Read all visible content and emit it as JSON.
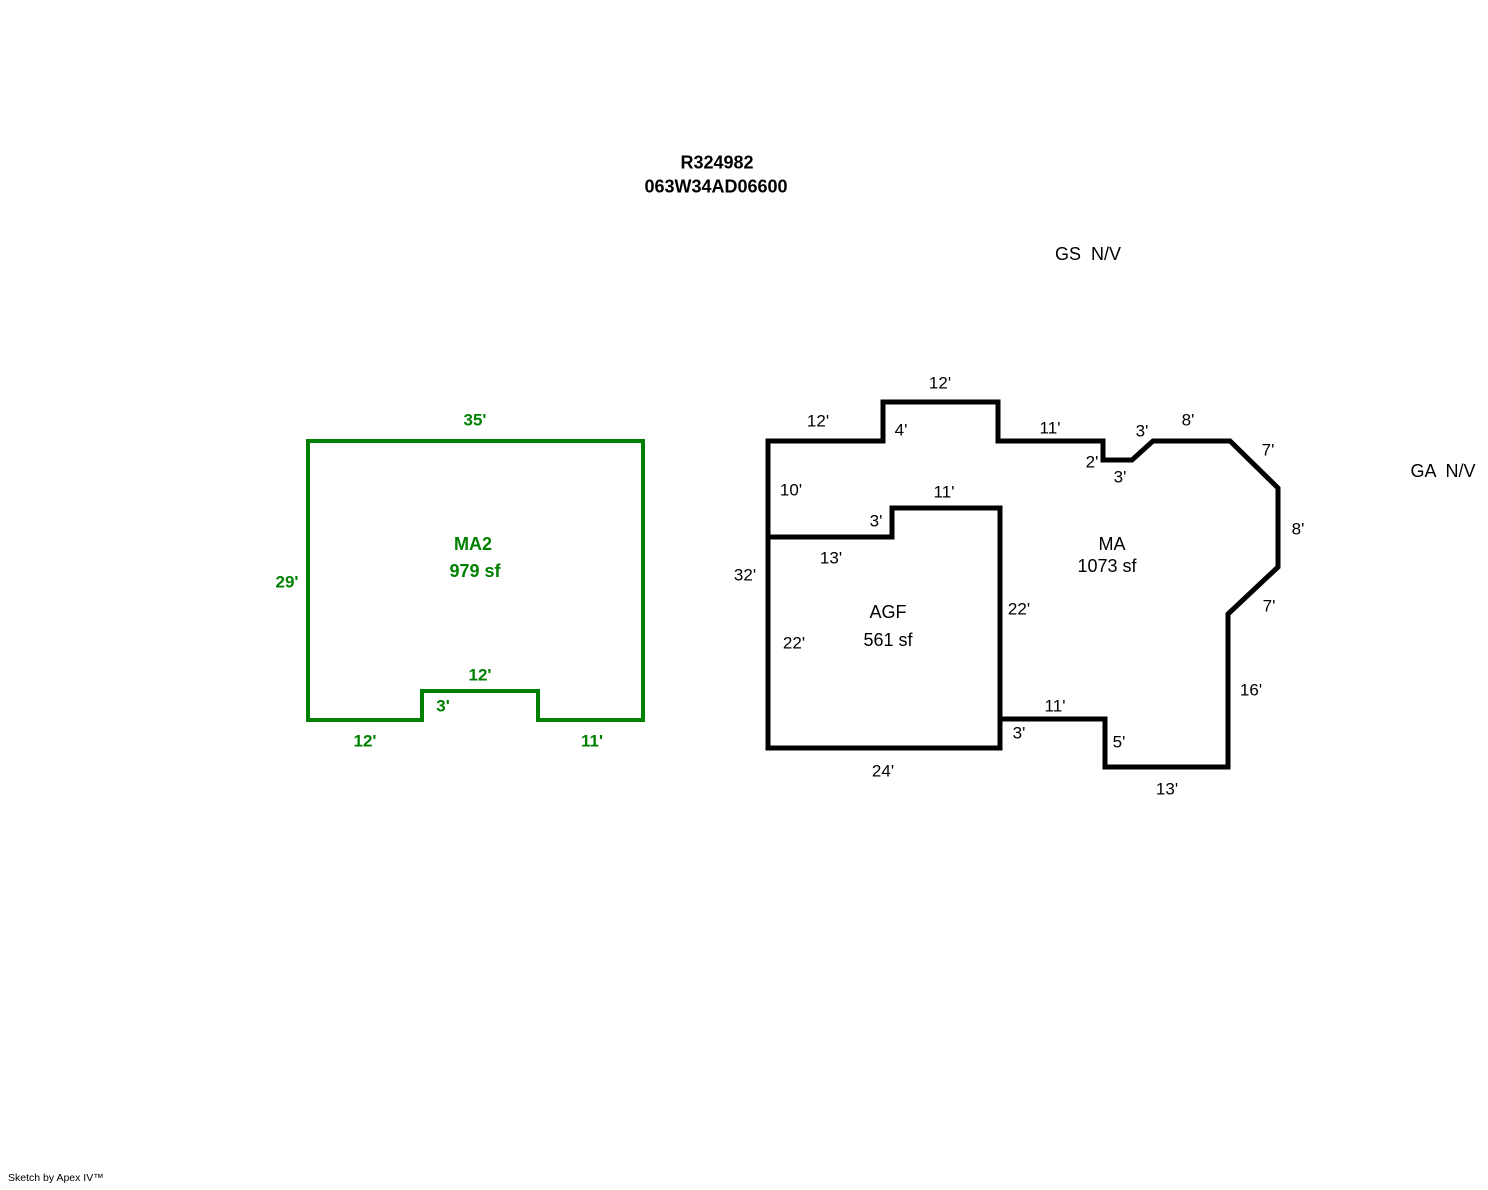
{
  "header": {
    "line1": "R324982",
    "line2": "063W34AD06600",
    "line1_x": 717,
    "line1_y": 163,
    "line2_x": 716,
    "line2_y": 187
  },
  "footer": {
    "credit": "Sketch by Apex IV™"
  },
  "colors": {
    "outline_black": "#000000",
    "outline_green": "#008000"
  },
  "sketch": {
    "canvas": {
      "width": 1488,
      "height": 1190
    },
    "shapes": [
      {
        "name": "ma2-outline",
        "type": "polygon",
        "color": "#008000",
        "stroke_width": 4,
        "points": [
          [
            308,
            441
          ],
          [
            643,
            441
          ],
          [
            643,
            720
          ],
          [
            538,
            720
          ],
          [
            538,
            691
          ],
          [
            422,
            691
          ],
          [
            422,
            720
          ],
          [
            308,
            720
          ]
        ]
      },
      {
        "name": "ma-outer-outline",
        "type": "polygon",
        "color": "#000000",
        "stroke_width": 5,
        "points": [
          [
            768,
            441
          ],
          [
            883,
            441
          ],
          [
            883,
            402
          ],
          [
            998,
            402
          ],
          [
            998,
            441
          ],
          [
            1103,
            441
          ],
          [
            1103,
            460
          ],
          [
            1132,
            460
          ],
          [
            1153,
            441
          ],
          [
            1230,
            441
          ],
          [
            1278,
            488
          ],
          [
            1278,
            567
          ],
          [
            1228,
            614
          ],
          [
            1228,
            767
          ],
          [
            1105,
            767
          ],
          [
            1105,
            719
          ],
          [
            1000,
            719
          ],
          [
            1000,
            748
          ],
          [
            768,
            748
          ]
        ]
      },
      {
        "name": "agf-divider-wall",
        "type": "polyline",
        "color": "#000000",
        "stroke_width": 5,
        "points": [
          [
            768,
            537
          ],
          [
            892,
            537
          ],
          [
            892,
            508
          ],
          [
            1000,
            508
          ],
          [
            1000,
            719
          ]
        ]
      }
    ],
    "labels": [
      {
        "name": "gs-novalue-label",
        "text": "GS  N/V",
        "x": 1088,
        "y": 254,
        "color": "#000000",
        "bold": false,
        "size": 18
      },
      {
        "name": "ga-novalue-label",
        "text": "GA  N/V",
        "x": 1443,
        "y": 471,
        "color": "#000000",
        "bold": false,
        "size": 18
      },
      {
        "name": "ma2-dim-top-35",
        "text": "35'",
        "x": 475,
        "y": 420,
        "color": "#008000",
        "bold": true,
        "size": 17
      },
      {
        "name": "ma2-dim-left-29",
        "text": "29'",
        "x": 287,
        "y": 582,
        "color": "#008000",
        "bold": true,
        "size": 17
      },
      {
        "name": "ma2-area-name",
        "text": "MA2",
        "x": 473,
        "y": 544,
        "color": "#008000",
        "bold": true,
        "size": 18
      },
      {
        "name": "ma2-area-size",
        "text": "979 sf",
        "x": 475,
        "y": 571,
        "color": "#008000",
        "bold": true,
        "size": 18
      },
      {
        "name": "ma2-dim-notch-top-12",
        "text": "12'",
        "x": 480,
        "y": 675,
        "color": "#008000",
        "bold": true,
        "size": 17
      },
      {
        "name": "ma2-dim-notch-3",
        "text": "3'",
        "x": 443,
        "y": 706,
        "color": "#008000",
        "bold": true,
        "size": 17
      },
      {
        "name": "ma2-dim-bottom-left-12",
        "text": "12'",
        "x": 365,
        "y": 741,
        "color": "#008000",
        "bold": true,
        "size": 17
      },
      {
        "name": "ma2-dim-bottom-right-11",
        "text": "11'",
        "x": 592,
        "y": 741,
        "color": "#008000",
        "bold": true,
        "size": 17
      },
      {
        "name": "ma-dim-12-upper-left",
        "text": "12'",
        "x": 818,
        "y": 421,
        "color": "#000000",
        "bold": false,
        "size": 17
      },
      {
        "name": "ma-dim-4-bump",
        "text": "4'",
        "x": 901,
        "y": 430,
        "color": "#000000",
        "bold": false,
        "size": 17
      },
      {
        "name": "ma-dim-12-bump-top",
        "text": "12'",
        "x": 940,
        "y": 383,
        "color": "#000000",
        "bold": false,
        "size": 17
      },
      {
        "name": "ma-dim-11-top",
        "text": "11'",
        "x": 1050,
        "y": 428,
        "color": "#000000",
        "bold": false,
        "size": 17
      },
      {
        "name": "ma-dim-2-step",
        "text": "2'",
        "x": 1092,
        "y": 462,
        "color": "#000000",
        "bold": false,
        "size": 17
      },
      {
        "name": "ma-dim-3-step-bottom",
        "text": "3'",
        "x": 1120,
        "y": 477,
        "color": "#000000",
        "bold": false,
        "size": 17
      },
      {
        "name": "ma-dim-3-diagonal",
        "text": "3'",
        "x": 1142,
        "y": 431,
        "color": "#000000",
        "bold": false,
        "size": 17
      },
      {
        "name": "ma-dim-8-top",
        "text": "8'",
        "x": 1188,
        "y": 420,
        "color": "#000000",
        "bold": false,
        "size": 17
      },
      {
        "name": "ma-dim-7-upper-diag",
        "text": "7'",
        "x": 1268,
        "y": 450,
        "color": "#000000",
        "bold": false,
        "size": 17
      },
      {
        "name": "ma-dim-8-right",
        "text": "8'",
        "x": 1298,
        "y": 529,
        "color": "#000000",
        "bold": false,
        "size": 17
      },
      {
        "name": "ma-dim-7-lower-diag",
        "text": "7'",
        "x": 1269,
        "y": 606,
        "color": "#000000",
        "bold": false,
        "size": 17
      },
      {
        "name": "ma-dim-16-right",
        "text": "16'",
        "x": 1251,
        "y": 690,
        "color": "#000000",
        "bold": false,
        "size": 17
      },
      {
        "name": "ma-dim-13-bottom",
        "text": "13'",
        "x": 1167,
        "y": 789,
        "color": "#000000",
        "bold": false,
        "size": 17
      },
      {
        "name": "ma-dim-5-step",
        "text": "5'",
        "x": 1119,
        "y": 742,
        "color": "#000000",
        "bold": false,
        "size": 17
      },
      {
        "name": "ma-dim-11-bottom",
        "text": "11'",
        "x": 1055,
        "y": 706,
        "color": "#000000",
        "bold": false,
        "size": 17
      },
      {
        "name": "ma-dim-3-bottom-step",
        "text": "3'",
        "x": 1019,
        "y": 733,
        "color": "#000000",
        "bold": false,
        "size": 17
      },
      {
        "name": "ma-dim-10-left",
        "text": "10'",
        "x": 791,
        "y": 490,
        "color": "#000000",
        "bold": false,
        "size": 17
      },
      {
        "name": "agf-dim-32-left",
        "text": "32'",
        "x": 745,
        "y": 575,
        "color": "#000000",
        "bold": false,
        "size": 17
      },
      {
        "name": "agf-dim-13-top",
        "text": "13'",
        "x": 831,
        "y": 558,
        "color": "#000000",
        "bold": false,
        "size": 17
      },
      {
        "name": "agf-dim-3-step",
        "text": "3'",
        "x": 876,
        "y": 521,
        "color": "#000000",
        "bold": false,
        "size": 17
      },
      {
        "name": "agf-dim-11-top",
        "text": "11'",
        "x": 944,
        "y": 492,
        "color": "#000000",
        "bold": false,
        "size": 17
      },
      {
        "name": "agf-dim-22-left",
        "text": "22'",
        "x": 794,
        "y": 643,
        "color": "#000000",
        "bold": false,
        "size": 17
      },
      {
        "name": "agf-dim-22-right",
        "text": "22'",
        "x": 1019,
        "y": 609,
        "color": "#000000",
        "bold": false,
        "size": 17
      },
      {
        "name": "agf-dim-24-bottom",
        "text": "24'",
        "x": 883,
        "y": 771,
        "color": "#000000",
        "bold": false,
        "size": 17
      },
      {
        "name": "agf-area-name",
        "text": "AGF",
        "x": 888,
        "y": 612,
        "color": "#000000",
        "bold": false,
        "size": 18
      },
      {
        "name": "agf-area-size",
        "text": "561 sf",
        "x": 888,
        "y": 640,
        "color": "#000000",
        "bold": false,
        "size": 18
      },
      {
        "name": "ma-area-name",
        "text": "MA",
        "x": 1112,
        "y": 544,
        "color": "#000000",
        "bold": false,
        "size": 18
      },
      {
        "name": "ma-area-size",
        "text": "1073 sf",
        "x": 1107,
        "y": 566,
        "color": "#000000",
        "bold": false,
        "size": 18
      }
    ]
  }
}
